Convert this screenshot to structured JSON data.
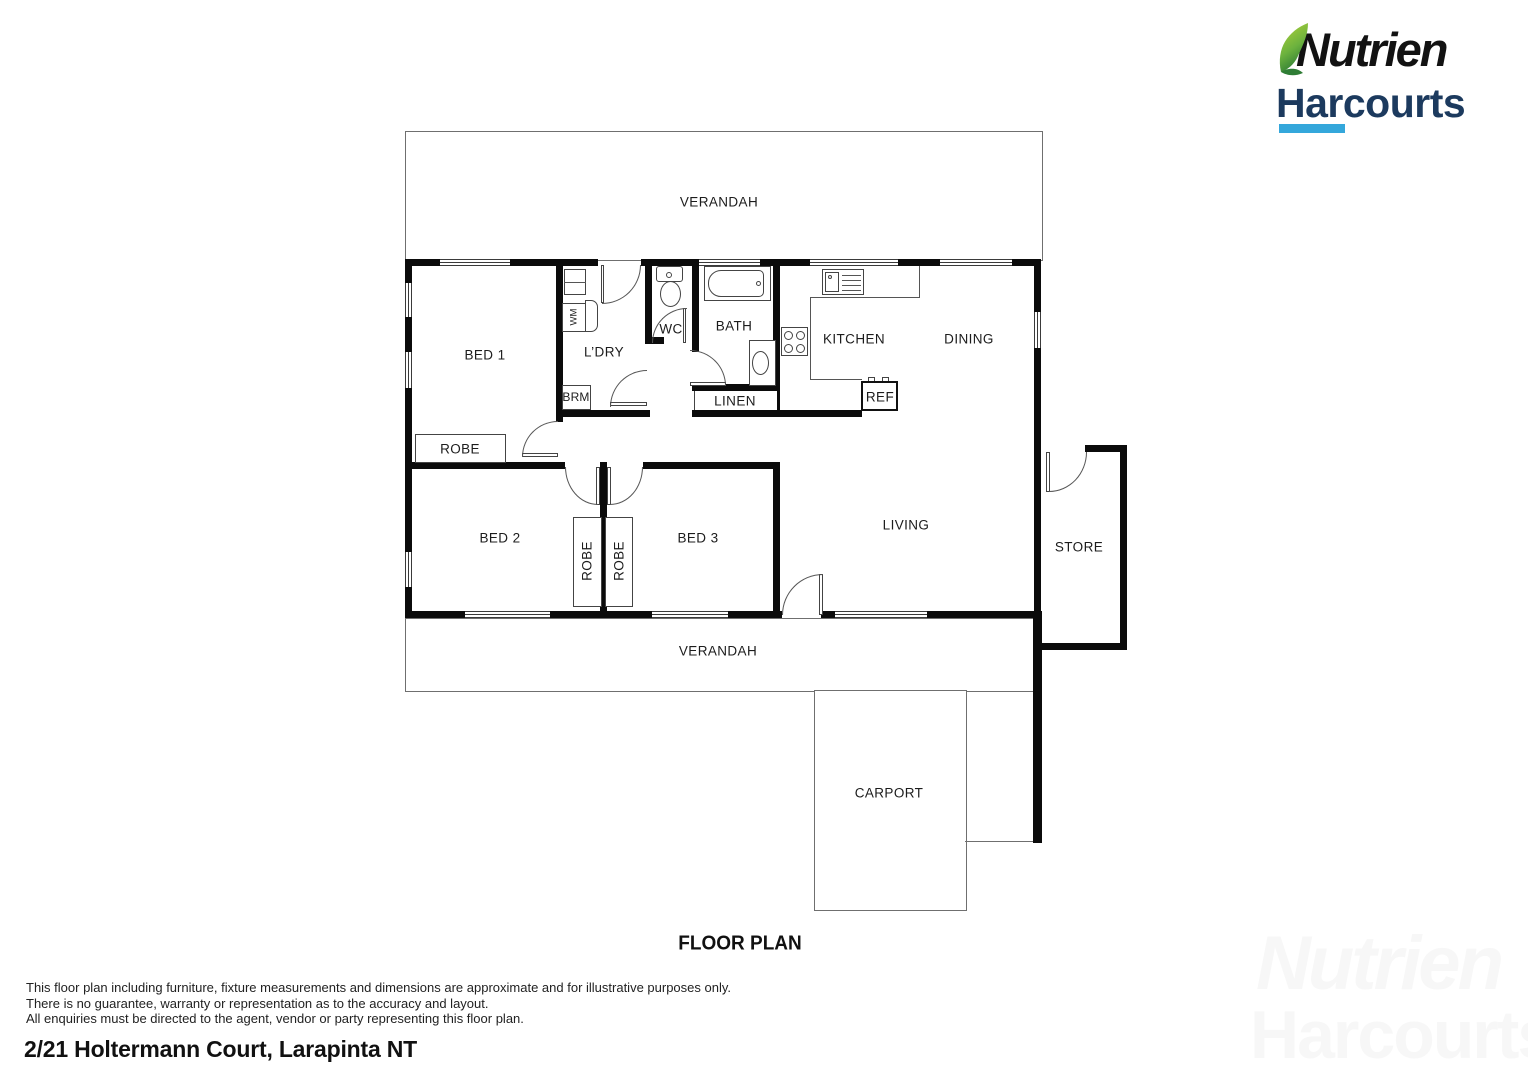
{
  "branding": {
    "logo_line1": "Nutrien",
    "logo_line2": "Harcourts",
    "leaf_color_light": "#a6ce39",
    "leaf_color_dark": "#2f7d35",
    "harcourts_navy": "#1c3a5e",
    "underline_blue": "#34a7db"
  },
  "watermark": {
    "line1": "Nutrien",
    "line2": "Harcourts"
  },
  "title": "FLOOR PLAN",
  "address": "2/21 Holtermann Court, Larapinta NT",
  "disclaimer": [
    "This floor plan including furniture, fixture measurements and dimensions are approximate and for illustrative purposes only.",
    "There is no guarantee, warranty or representation as to the accuracy and layout.",
    "All enquiries must be directed to the agent, vendor or party representing this floor plan."
  ],
  "rooms": {
    "verandah_top": "VERANDAH",
    "bed1": "BED 1",
    "robe1": "ROBE",
    "ldry": "L’DRY",
    "brm": "BRM",
    "wc": "WC",
    "bath": "BATH",
    "linen": "LINEN",
    "kitchen": "KITCHEN",
    "dining": "DINING",
    "ref": "REF",
    "bed2": "BED 2",
    "robe2": "ROBE",
    "robe3": "ROBE",
    "bed3": "BED 3",
    "living": "LIVING",
    "store": "STORE",
    "verandah_bottom": "VERANDAH",
    "carport": "CARPORT"
  },
  "fixtures": {
    "washing_machine": "WM"
  }
}
